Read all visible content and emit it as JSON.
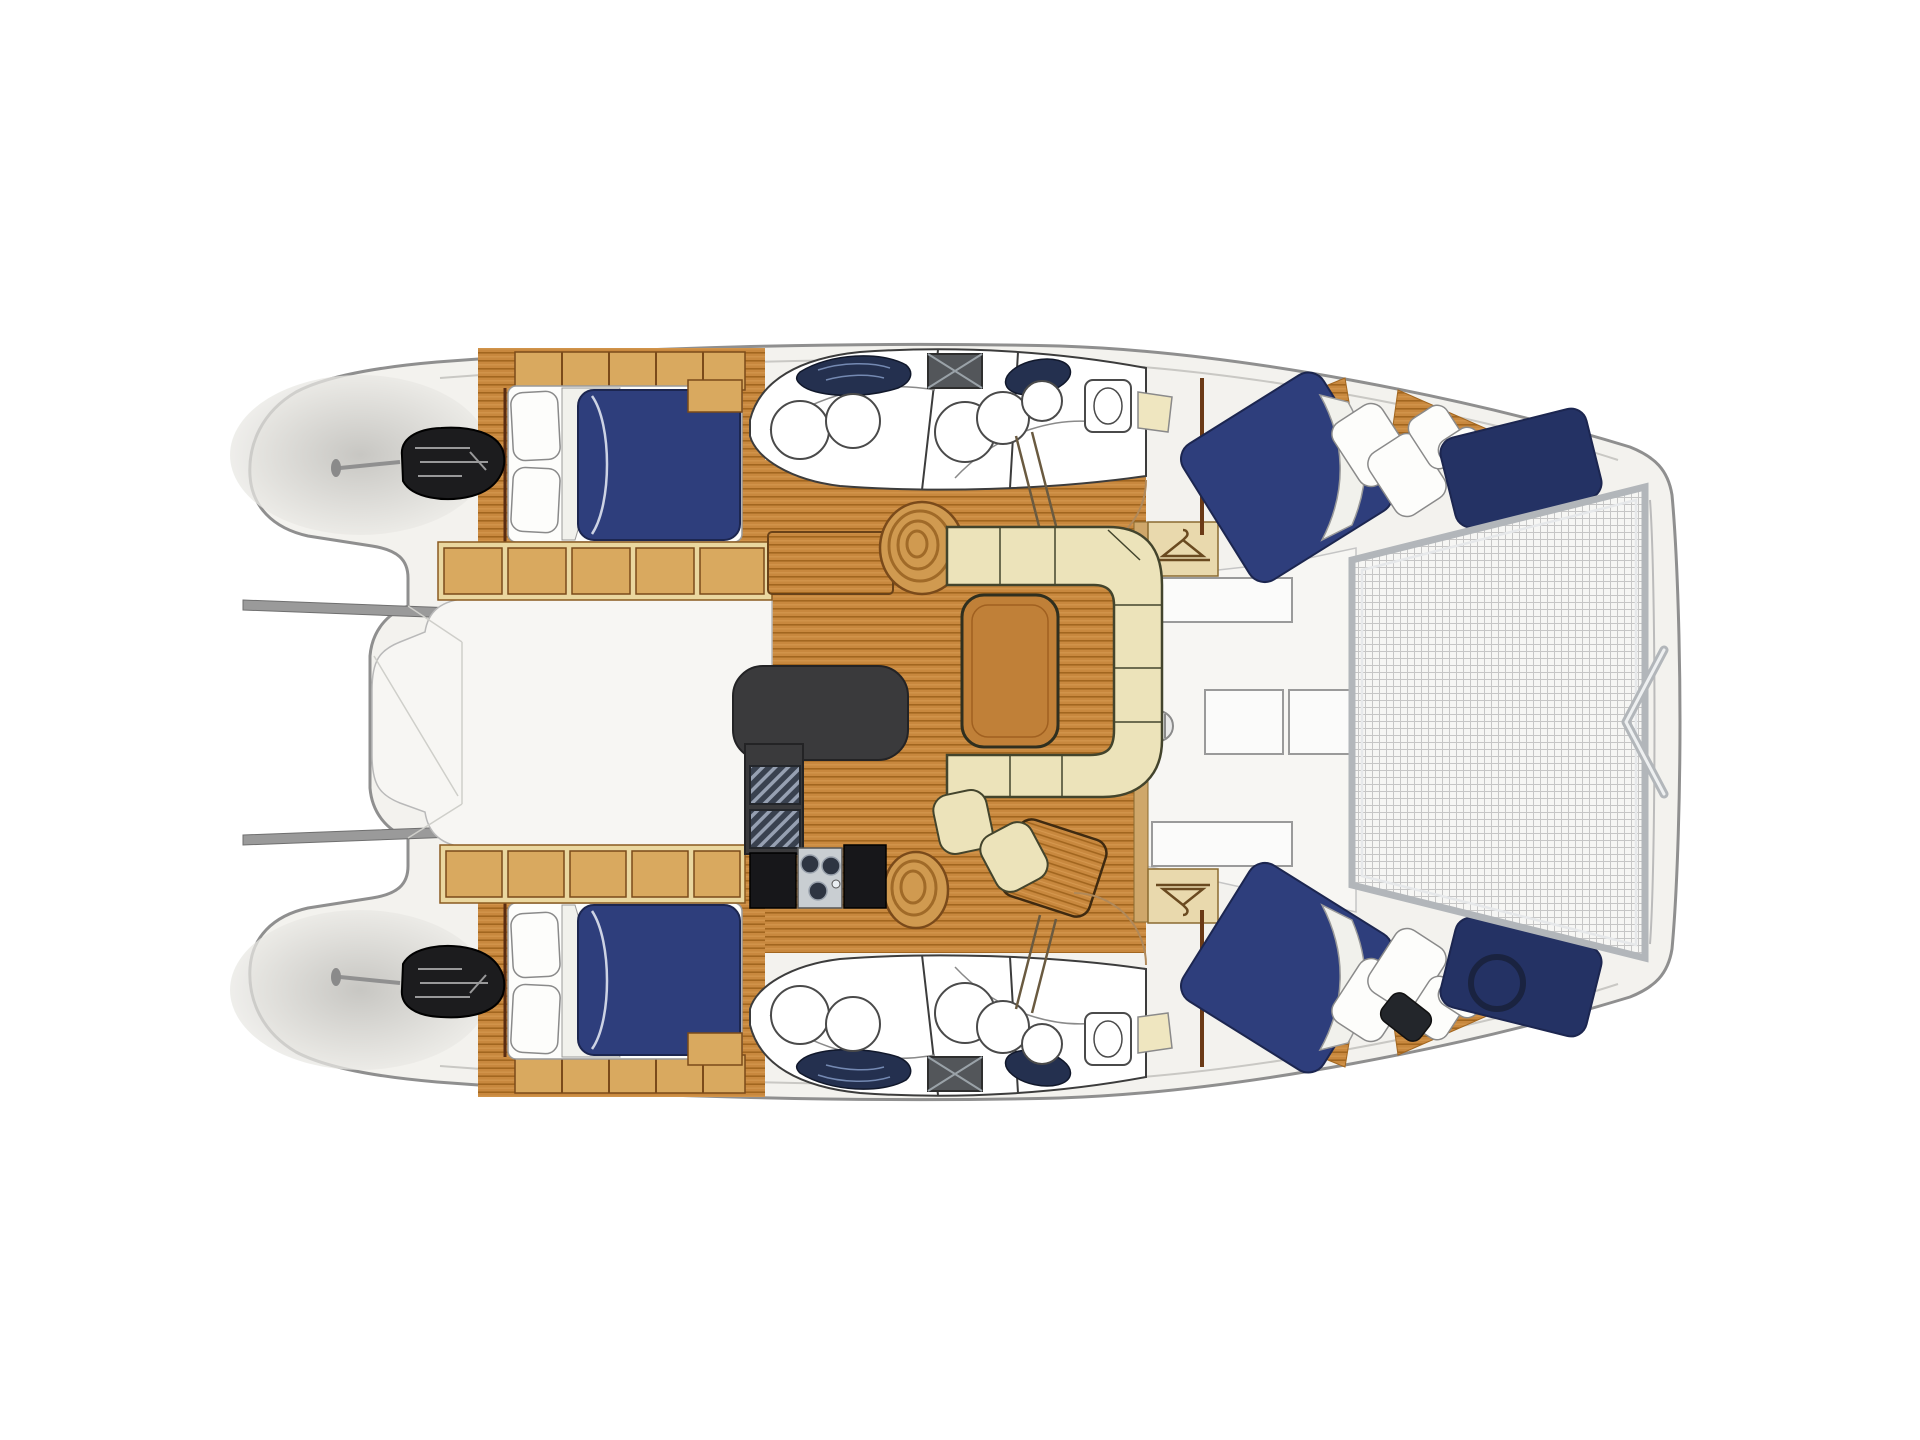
{
  "page": {
    "background": "#ffffff"
  },
  "plan": {
    "type": "catamaran-yacht-floor-plan",
    "view": "top-down",
    "orientation": "bow-right",
    "palette": {
      "hull": "#f3f2ee",
      "hull_outline": "#8f8f8f",
      "gunwale": "#c9c8c4",
      "deck_white": "#f7f6f3",
      "teak": "#c8883e",
      "teak_stripe": "#a2661f",
      "teak_light": "#d79a52",
      "cabinet_tan": "#d9a95f",
      "cabinet_cream": "#ead79f",
      "wood_outline": "#7a4a1a",
      "berth_navy": "#2e3e7c",
      "berth_navy_dark": "#243264",
      "berth_outline": "#1c2650",
      "pillow_white": "#fdfdfb",
      "settee_cream": "#ece3ba",
      "settee_outline": "#43442c",
      "table_wood": "#c08038",
      "counter_charcoal": "#3a3a3c",
      "appliance_black": "#17171a",
      "steel": "#b2b6ba",
      "steel_light": "#eef0f1",
      "vanity_navy": "#24304f",
      "glass_blue": "#7d93bd",
      "mesh_line": "#c6c6c6",
      "fixture_outline": "#4a4a4a",
      "shade_gray": "#d9d8d4"
    },
    "areas": [
      {
        "id": "salon",
        "floor": "teak"
      },
      {
        "id": "galley",
        "floor": "teak"
      },
      {
        "id": "cockpit-aft-deck",
        "floor": "white"
      },
      {
        "id": "foredeck",
        "floor": "white"
      },
      {
        "id": "trampoline-net",
        "floor": "mesh"
      },
      {
        "id": "port-aft-cabin",
        "berth": "double"
      },
      {
        "id": "starboard-aft-cabin",
        "berth": "double"
      },
      {
        "id": "port-forward-cabin",
        "berth": "double"
      },
      {
        "id": "starboard-forward-cabin",
        "berth": "double"
      },
      {
        "id": "port-head",
        "fixtures": [
          "toilet",
          "shower",
          "vanity-sink"
        ]
      },
      {
        "id": "starboard-head",
        "fixtures": [
          "toilet",
          "shower",
          "vanity-sink"
        ]
      },
      {
        "id": "port-engine-bay"
      },
      {
        "id": "starboard-engine-bay"
      }
    ],
    "icons": [
      "hanger-icon",
      "windlass-icon",
      "bow-bridle-icon",
      "hatch-x-icon",
      "engine-icon",
      "sink-basin-icon",
      "faucet-icon",
      "toilet-icon",
      "shower-icon",
      "davit-rod-icon"
    ]
  }
}
